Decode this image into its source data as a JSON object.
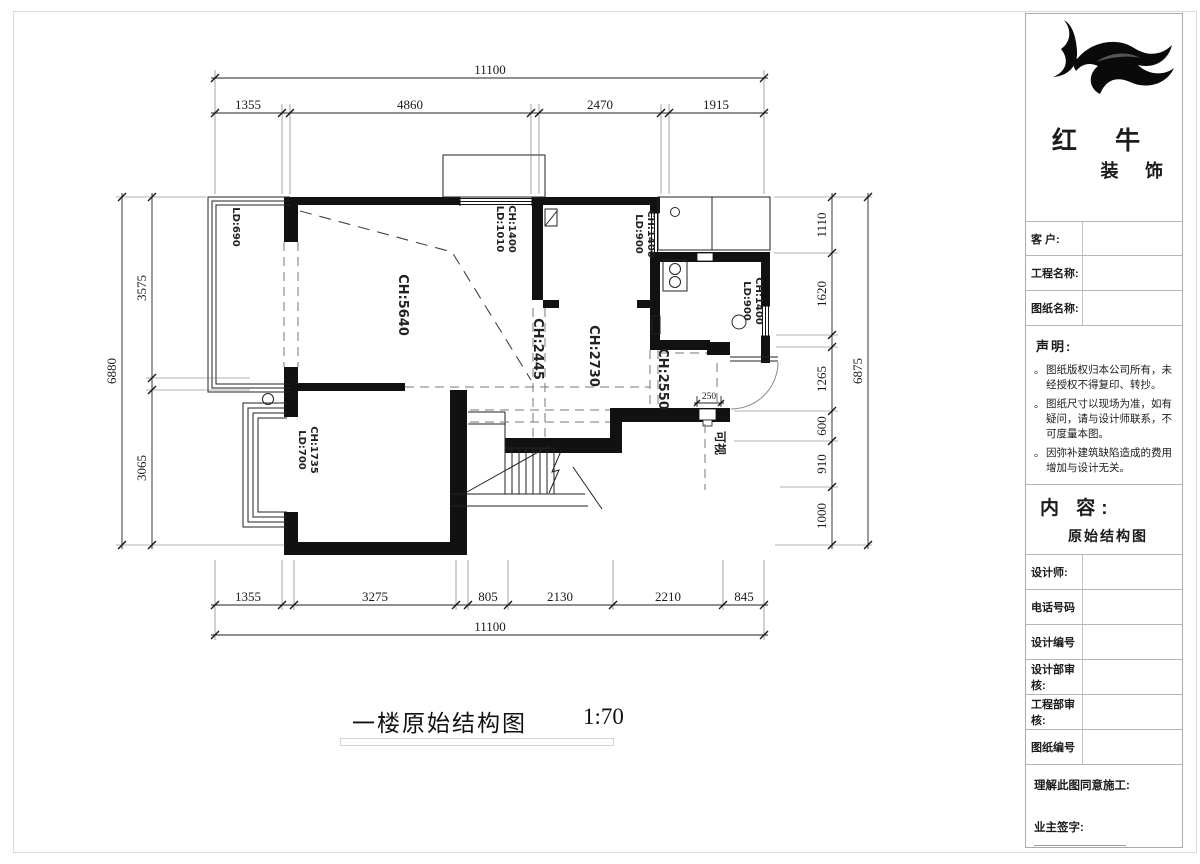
{
  "page": {
    "title": "一楼原始结构图",
    "scale": "1:70"
  },
  "plan": {
    "dims": {
      "top_total": "11100",
      "top": [
        "1355",
        "4860",
        "2470",
        "1915"
      ],
      "bottom": [
        "1355",
        "3275",
        "805",
        "2130",
        "2210",
        "845"
      ],
      "bottom_total": "11100",
      "left_total": "6880",
      "left": [
        "3575",
        "3065"
      ],
      "right_total": "6875",
      "right": [
        "1110",
        "1620",
        "1265",
        "600",
        "910",
        "1000"
      ]
    },
    "labels": {
      "balcony_ld": "LD:690",
      "living_ch": "CH:5640",
      "bedroom_ch": "CH:2730",
      "passage_ch": "CH:2445",
      "kitchen_pass_ch": "CH:2550",
      "intercom": "可视",
      "door_width": "250"
    },
    "windows": {
      "top": {
        "ld": "LD:1010",
        "ch": "CH:1400"
      },
      "bedroom": {
        "ld": "LD:900",
        "ch": "CH:1400"
      },
      "kitchen": {
        "ld": "LD:900",
        "ch": "CH:1400"
      },
      "bay": {
        "ld": "LD:700",
        "ch": "CH:1735"
      }
    }
  },
  "titleblock": {
    "brand": {
      "logo_icon": "bull-logo",
      "name_line1": "红 牛",
      "name_line2": "装 饰"
    },
    "rows": {
      "customer": "客 户:",
      "project": "工程名称:",
      "drawing": "图纸名称:"
    },
    "statement": {
      "heading": "声明:",
      "items": [
        "图纸版权归本公司所有，未经授权不得复印、转抄。",
        "图纸尺寸以现场为准，如有疑问，请与设计师联系，不可度量本图。",
        "因弥补建筑缺陷造成的费用增加与设计无关。"
      ]
    },
    "content": {
      "heading": "内 容:",
      "value": "原始结构图"
    },
    "fields": [
      "设计师:",
      "电话号码",
      "设计编号",
      "设计部审核:",
      "工程部审核:",
      "图纸编号"
    ],
    "footer": {
      "agree": "理解此图同意施工:",
      "sign": "业主签字:"
    }
  }
}
